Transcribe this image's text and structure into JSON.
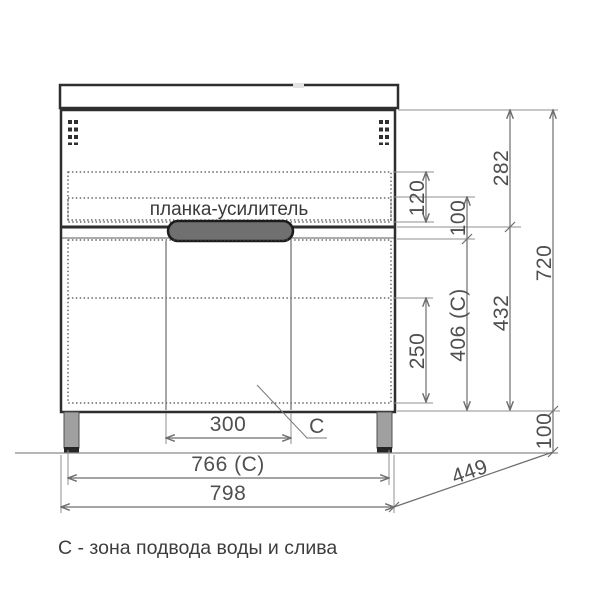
{
  "diagram": {
    "plank_label": "планка-усилитель",
    "zone_letter": "C",
    "caption": "С - зона подвода воды и слива",
    "dimensions": {
      "upper_section_height": "282",
      "plank_zone_height": "120",
      "plank_drop": "100",
      "total_height": "720",
      "lower_section_height": "432",
      "service_zone_height": "406 (C)",
      "drawer_inner_height": "250",
      "service_zone_width": "300",
      "feet_span_width": "766 (C)",
      "total_width": "798",
      "depth": "449",
      "leg_height": "100"
    },
    "colors": {
      "service_zone_fill": "#b7d2ec",
      "plank_fill": "#d9d9d9",
      "handle_fill": "#707070",
      "leg_fill": "#a0a0a0",
      "leg_foot_fill": "#262626",
      "outline": "#2e2e2e",
      "dimension": "#6e6e6e"
    }
  }
}
